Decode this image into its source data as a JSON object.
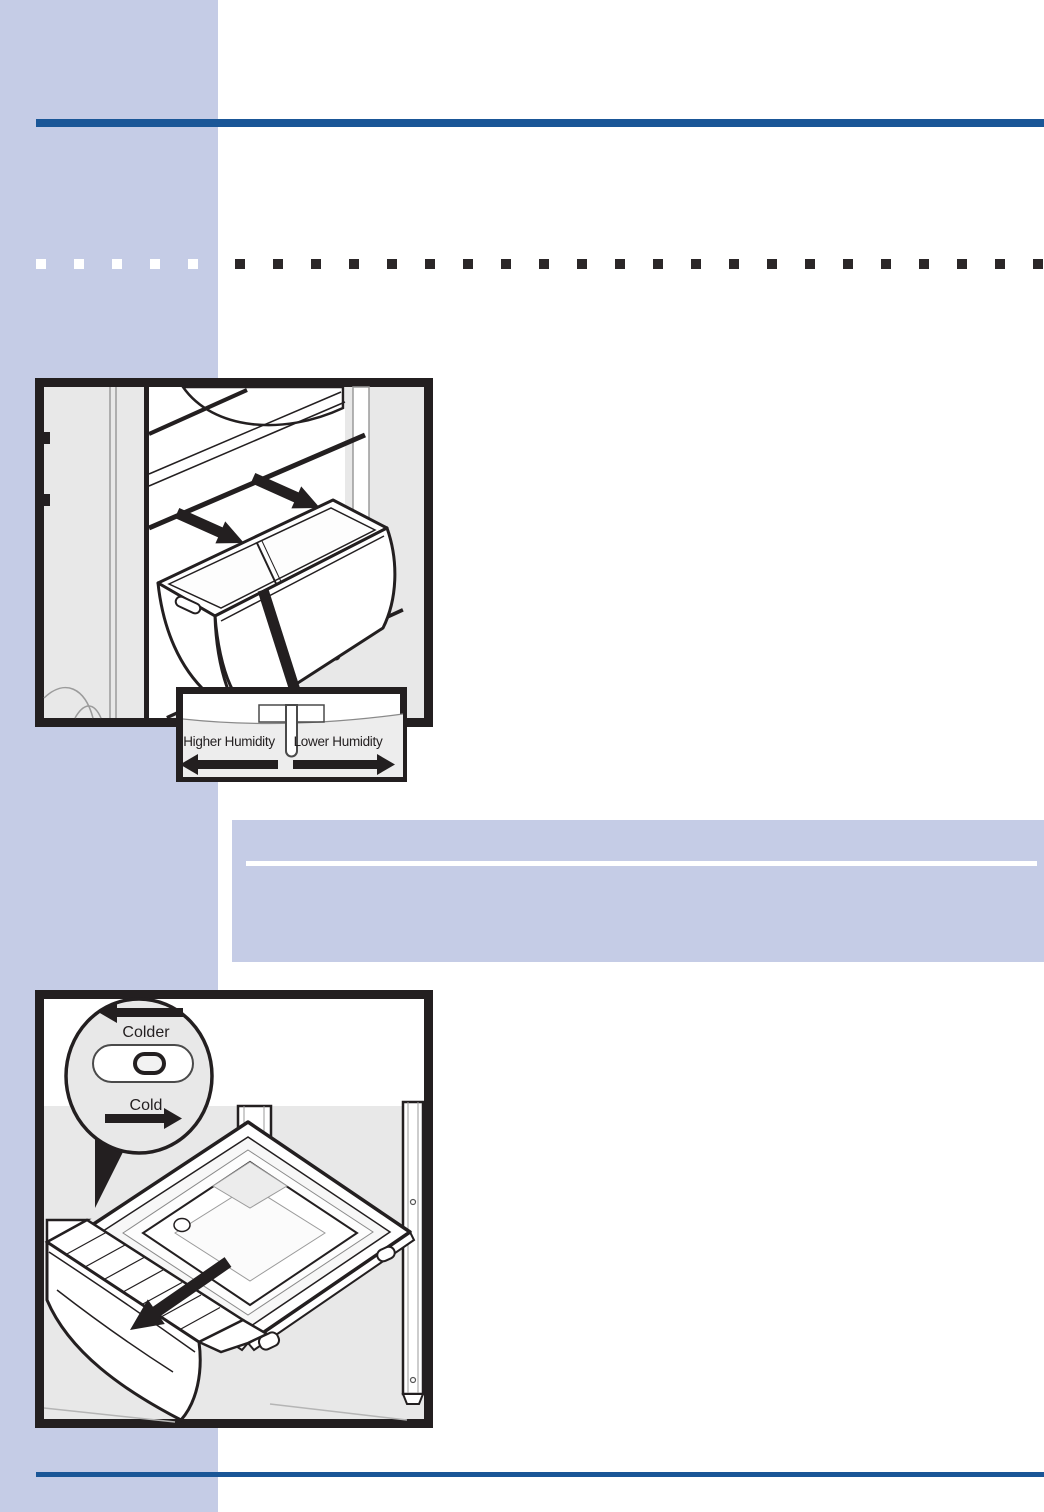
{
  "page": {
    "background": "#ffffff",
    "accent_rule_color": "#1a5697",
    "sidebar_color": "#c5cce6",
    "divider_squares": {
      "light_count": 5,
      "dark_count": 22,
      "light_color": "#ffffff",
      "dark_color": "#2b2728",
      "light_start_x": 36,
      "dark_start_x": 235,
      "step": 38
    }
  },
  "note_panel": {
    "background": "#c5cce6",
    "rule_color": "#ffffff"
  },
  "figures": {
    "crisper": {
      "description": "crisper-drawer-pull-out-illustration",
      "inset": {
        "left_label": "Higher Humidity",
        "right_label": "Lower Humidity"
      }
    },
    "meat_drawer": {
      "description": "meat-drawer-pull-out-illustration",
      "inset": {
        "top_label": "Colder",
        "bottom_label": "Cold"
      }
    }
  }
}
